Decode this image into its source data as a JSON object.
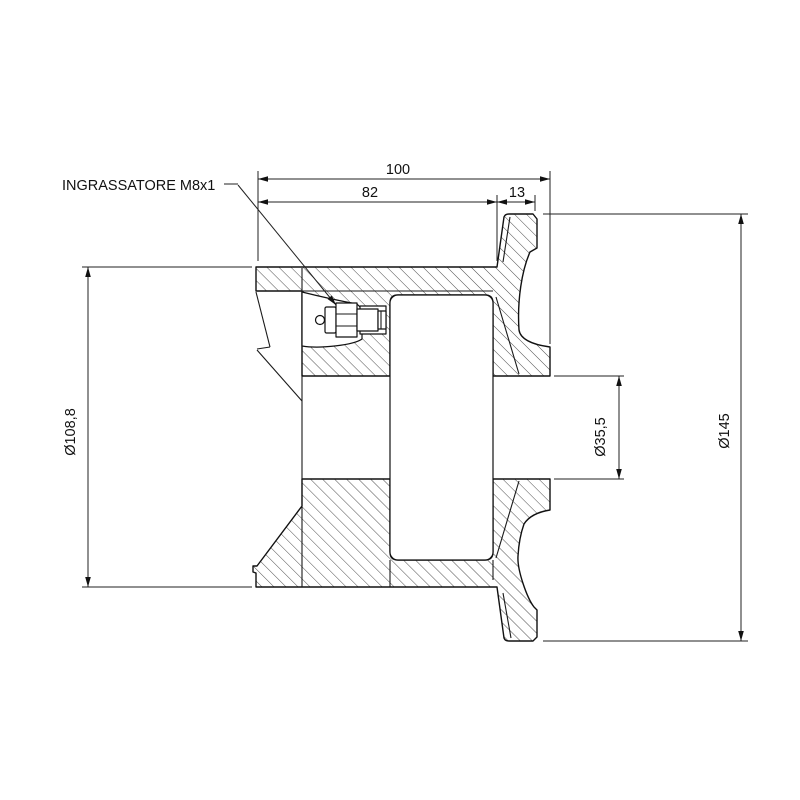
{
  "drawing": {
    "title": "flanged-wheel-cross-section",
    "callout": {
      "label": "INGRASSATORE M8x1"
    },
    "dimensions": {
      "overall_width": "100",
      "wheel_width": "82",
      "flange_thickness": "13",
      "wheel_diameter": "Ø108,8",
      "bore_diameter": "Ø35,5",
      "flange_diameter": "Ø145"
    },
    "colors": {
      "line": "#111111",
      "background": "#ffffff"
    }
  }
}
